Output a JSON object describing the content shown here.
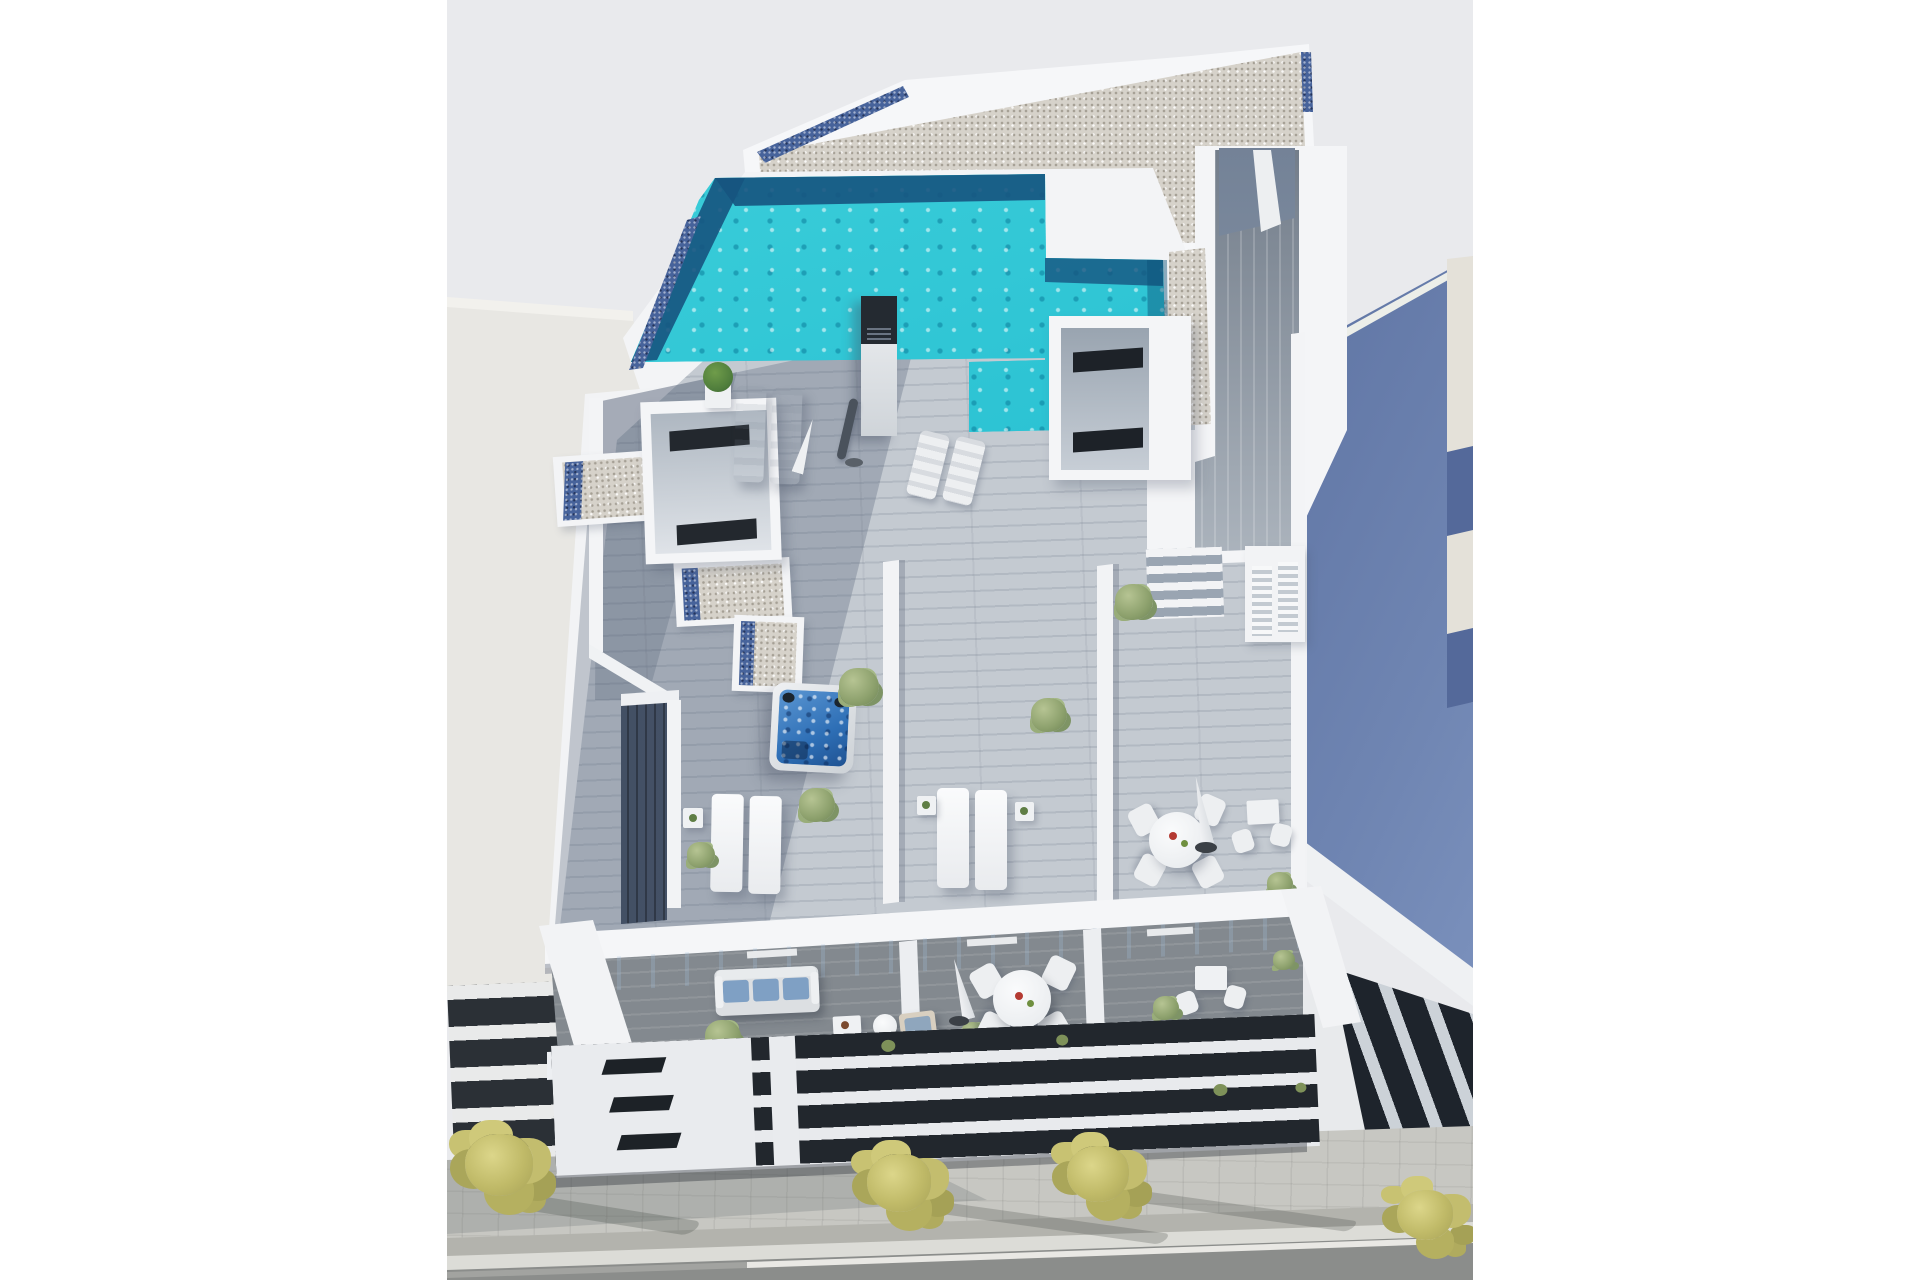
{
  "document": {
    "kind": "3d-architectural-render",
    "view": "aerial top-down perspective",
    "subject": "Modern white apartment building with rooftop pool, roof terraces and balconies between two neighbouring buildings on a street"
  },
  "palette": {
    "page_margin": "#ffffff",
    "render_background": "#e9eaed",
    "building_white": "#f4f5f7",
    "gravel_roof": "#d6d2ca",
    "pebble_border_blue": "#47639b",
    "pool_water": "#28c2d4",
    "pool_shadow_navy": "#19567f",
    "hot_tub_water": "#2e6fb6",
    "roof_deck_wood": "#c4cad1",
    "deck_shadow": "#5c6b84",
    "balcony_deck": "#83898f",
    "glazing_dark": "#23282e",
    "cushion_blue": "#7fa0c4",
    "shrub_green": "#8ca06c",
    "tree_yellow_green": "#c0ba68",
    "sidewalk": "#c7c7c2",
    "road_asphalt": "#8b8d8b",
    "neighbor_left_wall": "#e4e3df",
    "neighbor_right_wall": "#54699a",
    "neighbor_right_edge": "#e4e1d9",
    "accent_red": "#b43a32"
  },
  "environment": {
    "street": {
      "elements": [
        "paved sidewalk",
        "kerb",
        "asphalt road",
        "white road line"
      ],
      "trees": {
        "count": 4,
        "foliage": "yellow-green",
        "shadows": "cast to lower right"
      }
    },
    "neighbor_buildings": {
      "left": {
        "description": "plain light-grey building volume with white louvre base over dark glazing"
      },
      "right": {
        "description": "slate-blue building volume with beige roof edge and dark louvre glazing base"
      }
    }
  },
  "building": {
    "roof": {
      "finish": "light gravel with blue pebble border strips",
      "pool": {
        "shape": "L-shaped",
        "features": [
          "turquoise water",
          "navy shadow edge",
          "raised white parapet"
        ]
      },
      "features": [
        "plank deck walkway",
        "two deck stairs",
        "two rooflight boxes with dark slots",
        "outdoor shower column",
        "gravel planter boxes",
        "hot tub"
      ]
    },
    "terraces": [
      {
        "id": "left",
        "furniture": [
          "2 padded sun loungers",
          "2 deck chairs",
          "2 slatted sun loungers",
          "side table",
          "closed dark parasol",
          "closed white parasol",
          "potted bonsai",
          "hot tub",
          "shrubs"
        ]
      },
      {
        "id": "center",
        "furniture": [
          "2 sun loungers",
          "2 side tables",
          "shrubs"
        ]
      },
      {
        "id": "right",
        "furniture": [
          "round dining table",
          "4 chairs",
          "closed white parasol",
          "bistro table",
          "2 chairs",
          "louvre cabinet",
          "potted shrubs"
        ]
      }
    ],
    "balconies": [
      {
        "id": "left",
        "furniture": [
          "3-seat sofa with blue cushions",
          "round coffee table",
          "side table",
          "wooden lounge chair with blue cushion",
          "potted shrubs"
        ]
      },
      {
        "id": "center",
        "furniture": [
          "round dining table",
          "4 chairs",
          "closed white parasol",
          "red and green tableware accents"
        ]
      },
      {
        "id": "right",
        "furniture": [
          "bistro table",
          "2 chairs",
          "potted shrubs"
        ]
      }
    ],
    "facade": "horizontal white louvre slats over dark glazing with three small vent slots and white pillars"
  },
  "text": {
    "visible_text": "none"
  }
}
